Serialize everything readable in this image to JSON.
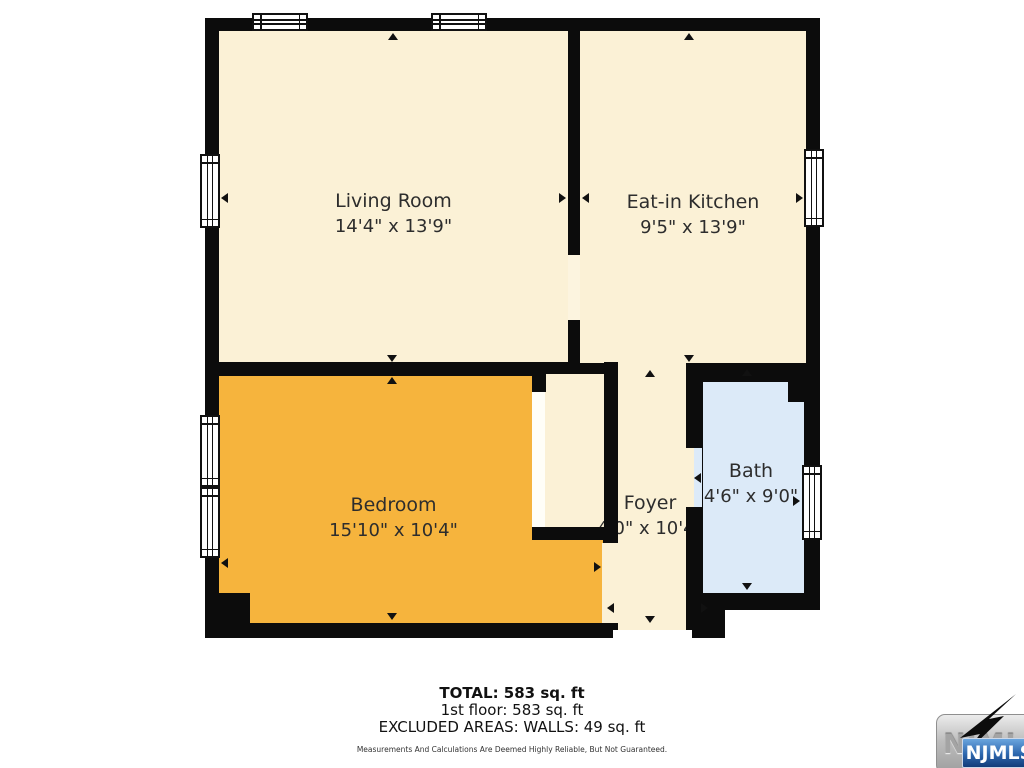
{
  "plan": {
    "wall_color": "#0c0c0c",
    "rooms": [
      {
        "name": "Living Room",
        "dims": "14'4\" x 13'9\"",
        "color": "#FBF1D6"
      },
      {
        "name": "Eat-in Kitchen",
        "dims": "9'5\" x 13'9\"",
        "color": "#FBF1D6"
      },
      {
        "name": "Bedroom",
        "dims": "15'10\" x 10'4\"",
        "color": "#F6B43D"
      },
      {
        "name": "Foyer",
        "dims": "4'0\" x 10'4\"",
        "color": "#FBF1D6"
      },
      {
        "name": "Bath",
        "dims": "4'6\" x 9'0\"",
        "color": "#DCEAF8"
      }
    ]
  },
  "summary": {
    "total": "TOTAL: 583 sq. ft",
    "floor1": "1st floor: 583 sq. ft",
    "excluded": "EXCLUDED AREAS: WALLS: 49 sq. ft",
    "disclaimer": "Measurements And Calculations Are Deemed Highly Reliable, But Not Guaranteed."
  },
  "logo": {
    "watermark": "NJMLS",
    "badge": "NJMLS",
    "badge_color": "#1c4f96"
  }
}
